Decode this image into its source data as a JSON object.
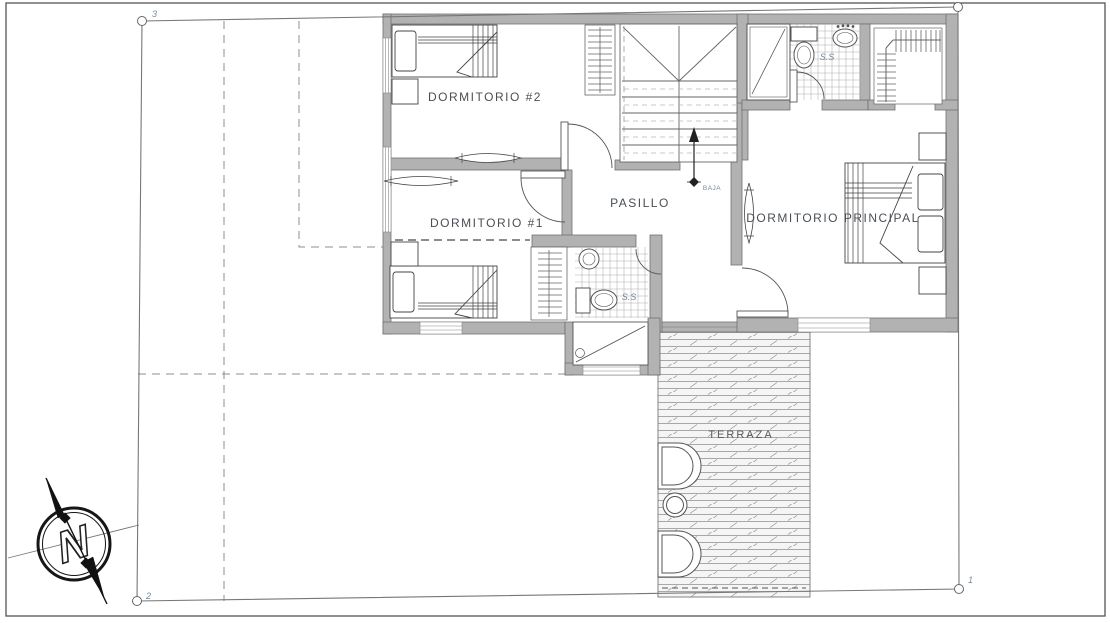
{
  "plan": {
    "rooms": {
      "bedroom2": {
        "label": "DORMITORIO #2"
      },
      "bedroom1": {
        "label": "DORMITORIO #1"
      },
      "hallway": {
        "label": "PASILLO"
      },
      "master_bedroom": {
        "label": "DORMITORIO PRINCIPAL"
      },
      "terrace": {
        "label": "TERRAZA"
      }
    },
    "annotations": {
      "stair_direction": "BAJA",
      "bathroom_top_label": "S.S",
      "bathroom_mid_label": "S.S"
    },
    "boundary_markers": {
      "top_left": "3",
      "bottom_left": "2",
      "bottom_right": "1"
    },
    "compass": {
      "letter": "N"
    },
    "colors": {
      "wall_fill": "#b2b2b2",
      "wall_edge": "#707070",
      "line": "#555555",
      "room_label": "#4a4f55",
      "accent_label": "#7189a0",
      "hatch_line": "#8f8f8f",
      "paper": "#ffffff"
    }
  }
}
